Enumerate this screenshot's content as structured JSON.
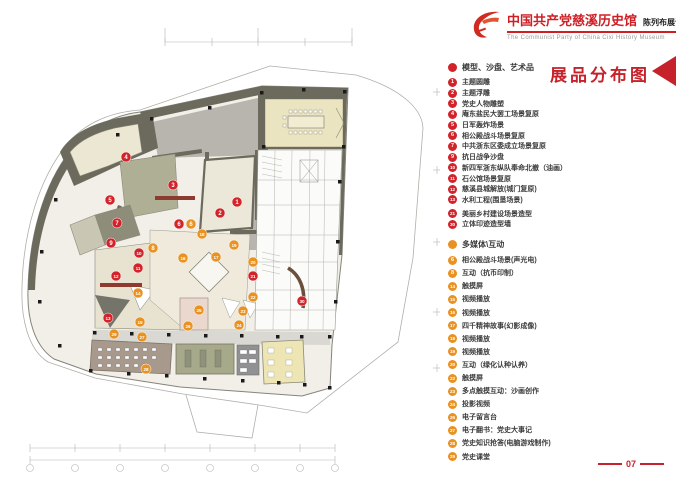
{
  "header": {
    "logo": "party-emblem-swoosh",
    "title_cn": "中国共产党慈溪历史馆",
    "subtitle_cn": "陈列布展设计施工方案",
    "subtitle_en": "The Communist Party of China Cixi  History Museum"
  },
  "sheet_title": "展品分布图",
  "page_number": "07",
  "colors": {
    "red": "#d2232a",
    "orange": "#e99121",
    "accent_red": "#c6222b"
  },
  "legend": {
    "sections": [
      {
        "header": "模型、沙盘、艺术品",
        "color": "red",
        "items": [
          {
            "n": "1",
            "label": "主题圆雕"
          },
          {
            "n": "2",
            "label": "主题浮雕"
          },
          {
            "n": "3",
            "label": "党史人物雕塑"
          },
          {
            "n": "4",
            "label": "庵东盐民大罢工场景复原"
          },
          {
            "n": "5",
            "label": "日军轰炸场景"
          },
          {
            "n": "6",
            "label": "相公殿战斗场景复原"
          },
          {
            "n": "7",
            "label": "中共浙东区委成立场景复原"
          },
          {
            "n": "9",
            "label": "抗日战争沙盘"
          },
          {
            "n": "10",
            "label": "新四军浙东纵队奉命北撤（油画）"
          },
          {
            "n": "11",
            "label": "石公馆场景复原"
          },
          {
            "n": "12",
            "label": "慈溪县城解放(城门复原)"
          },
          {
            "n": "13",
            "label": "水利工程(围垦场景)"
          },
          {
            "n": "21",
            "label": "美丽乡村建设场景造型"
          },
          {
            "n": "30",
            "label": "立体印迹造型墙"
          }
        ]
      },
      {
        "header": "多媒体\\互动",
        "color": "orange",
        "items": [
          {
            "n": "6",
            "label": "相公殿战斗场景(声光电)"
          },
          {
            "n": "8",
            "label": "互动（抗币印制）"
          },
          {
            "n": "14",
            "label": "触摸屏"
          },
          {
            "n": "15",
            "label": "视频播放"
          },
          {
            "n": "16",
            "label": "视频播放"
          },
          {
            "n": "17",
            "label": "四千精神故事(幻影成像)"
          },
          {
            "n": "18",
            "label": "视频播放"
          },
          {
            "n": "19",
            "label": "视频播放"
          },
          {
            "n": "20",
            "label": "互动（绿化认种认养）"
          },
          {
            "n": "22",
            "label": "触摸屏"
          },
          {
            "n": "23",
            "label": "多点触摸互动：沙画创作"
          },
          {
            "n": "24",
            "label": "投影视频"
          },
          {
            "n": "26",
            "label": "电子留言台"
          },
          {
            "n": "27",
            "label": "电子翻书：党史大事记"
          },
          {
            "n": "28",
            "label": "党史知识抢答(电脑游戏制作)"
          },
          {
            "n": "29",
            "label": "党史课堂"
          }
        ]
      }
    ]
  },
  "plan": {
    "markers": [
      {
        "n": "1",
        "x": 237,
        "y": 202,
        "c": "red"
      },
      {
        "n": "2",
        "x": 220,
        "y": 213,
        "c": "red"
      },
      {
        "n": "3",
        "x": 173,
        "y": 185,
        "c": "red"
      },
      {
        "n": "4",
        "x": 126,
        "y": 157,
        "c": "red"
      },
      {
        "n": "5",
        "x": 110,
        "y": 200,
        "c": "red"
      },
      {
        "n": "6",
        "x": 179,
        "y": 224,
        "c": "red"
      },
      {
        "n": "7",
        "x": 117,
        "y": 223,
        "c": "red"
      },
      {
        "n": "9",
        "x": 111,
        "y": 243,
        "c": "red"
      },
      {
        "n": "10",
        "x": 139,
        "y": 253,
        "c": "red"
      },
      {
        "n": "11",
        "x": 138,
        "y": 268,
        "c": "red"
      },
      {
        "n": "12",
        "x": 116,
        "y": 276,
        "c": "red"
      },
      {
        "n": "13",
        "x": 108,
        "y": 318,
        "c": "red"
      },
      {
        "n": "21",
        "x": 253,
        "y": 276,
        "c": "red"
      },
      {
        "n": "30",
        "x": 302,
        "y": 301,
        "c": "red"
      },
      {
        "n": "6",
        "x": 191,
        "y": 224,
        "c": "orange"
      },
      {
        "n": "8",
        "x": 153,
        "y": 248,
        "c": "orange"
      },
      {
        "n": "14",
        "x": 138,
        "y": 293,
        "c": "orange"
      },
      {
        "n": "15",
        "x": 140,
        "y": 322,
        "c": "orange"
      },
      {
        "n": "16",
        "x": 183,
        "y": 258,
        "c": "orange"
      },
      {
        "n": "17",
        "x": 216,
        "y": 257,
        "c": "orange"
      },
      {
        "n": "18",
        "x": 202,
        "y": 234,
        "c": "orange"
      },
      {
        "n": "19",
        "x": 234,
        "y": 245,
        "c": "orange"
      },
      {
        "n": "20",
        "x": 253,
        "y": 262,
        "c": "orange"
      },
      {
        "n": "22",
        "x": 253,
        "y": 297,
        "c": "orange"
      },
      {
        "n": "23",
        "x": 243,
        "y": 311,
        "c": "orange"
      },
      {
        "n": "24",
        "x": 239,
        "y": 325,
        "c": "orange"
      },
      {
        "n": "25",
        "x": 199,
        "y": 310,
        "c": "orange"
      },
      {
        "n": "26",
        "x": 188,
        "y": 326,
        "c": "orange"
      },
      {
        "n": "27",
        "x": 142,
        "y": 337,
        "c": "orange"
      },
      {
        "n": "28",
        "x": 146,
        "y": 369,
        "c": "orange"
      },
      {
        "n": "29",
        "x": 114,
        "y": 334,
        "c": "orange"
      }
    ]
  }
}
